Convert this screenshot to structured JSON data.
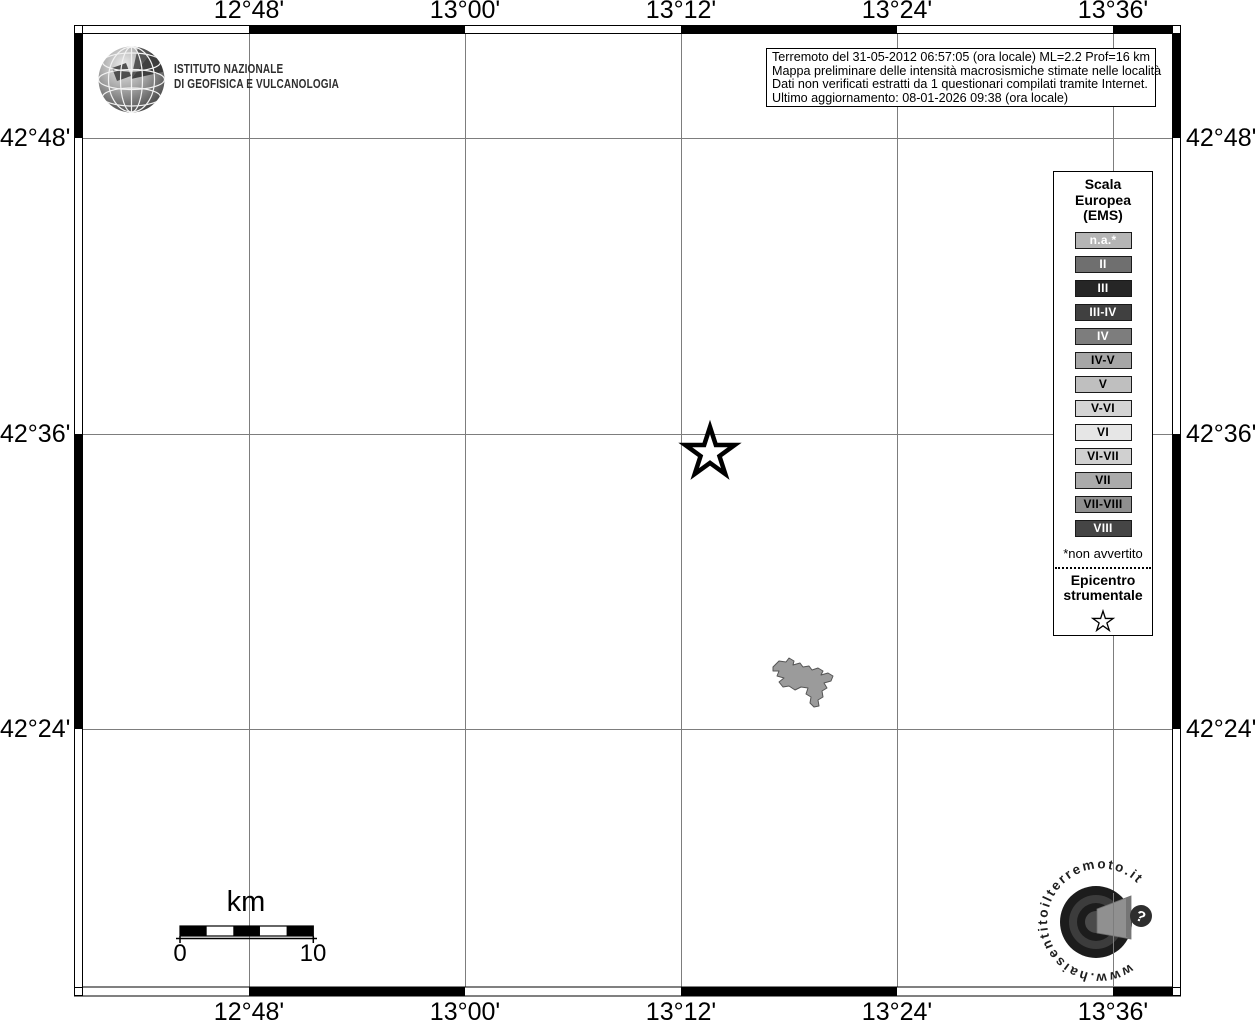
{
  "axes": {
    "top": [
      "12°48'",
      "13°00'",
      "13°12'",
      "13°24'",
      "13°36'"
    ],
    "bottom": [
      "12°48'",
      "13°00'",
      "13°12'",
      "13°24'",
      "13°36'"
    ],
    "left": [
      "42°48'",
      "42°36'",
      "42°24'"
    ],
    "right": [
      "42°48'",
      "42°36'",
      "42°24'"
    ]
  },
  "branding": {
    "ingv_line1": "ISTITUTO NAZIONALE",
    "ingv_line2": "DI GEOFISICA E VULCANOLOGIA"
  },
  "infobox": {
    "lines": [
      "Terremoto del 31-05-2012 06:57:05 (ora locale) ML=2.2 Prof=16 km",
      "Mappa preliminare delle intensità macrosismiche stimate nelle località",
      "Dati non verificati estratti da 1 questionari compilati tramite Internet.",
      "Ultimo aggiornamento: 08-01-2026 09:38 (ora locale)"
    ]
  },
  "legend": {
    "title_lines": [
      "Scala",
      "Europea",
      "(EMS)"
    ],
    "items": [
      {
        "label": "n.a.*",
        "bg": "#b5b5b5",
        "fg": "#ffffff"
      },
      {
        "label": "II",
        "bg": "#6f6f6f",
        "fg": "#ffffff"
      },
      {
        "label": "III",
        "bg": "#262626",
        "fg": "#ffffff"
      },
      {
        "label": "III-IV",
        "bg": "#404040",
        "fg": "#ffffff"
      },
      {
        "label": "IV",
        "bg": "#7d7d7d",
        "fg": "#ffffff"
      },
      {
        "label": "IV-V",
        "bg": "#a6a6a6",
        "fg": "#000000"
      },
      {
        "label": "V",
        "bg": "#bfbfbf",
        "fg": "#000000"
      },
      {
        "label": "V-VI",
        "bg": "#d4d4d4",
        "fg": "#000000"
      },
      {
        "label": "VI",
        "bg": "#e6e6e6",
        "fg": "#000000"
      },
      {
        "label": "VI-VII",
        "bg": "#d0d0d0",
        "fg": "#000000"
      },
      {
        "label": "VII",
        "bg": "#ababab",
        "fg": "#000000"
      },
      {
        "label": "VII-VIII",
        "bg": "#8f8f8f",
        "fg": "#000000"
      },
      {
        "label": "VIII",
        "bg": "#454545",
        "fg": "#ffffff"
      }
    ],
    "footnote": "*non avvertito",
    "epicenter_line1": "Epicentro",
    "epicenter_line2": "strumentale"
  },
  "scalebar": {
    "unit": "km",
    "start_label": "0",
    "end_label": "10"
  },
  "hsit": {
    "url_text": "www.haisentitoilterremoto.it",
    "badge_label": "?"
  },
  "colors": {
    "grid_line": "#7d7d7d",
    "frame": "#000000",
    "land_fill": "#9b9b9b",
    "epicenter_stroke": "#000000"
  }
}
